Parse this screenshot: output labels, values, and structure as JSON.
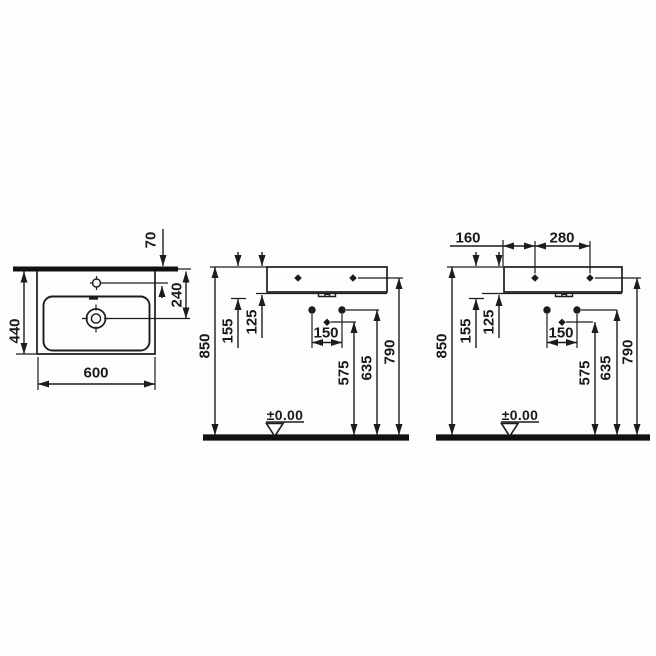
{
  "page": {
    "background": "#fdfdfd",
    "ink_color": "#1c1c1c",
    "description": "Technical dimension drawing of a rectangular wall-hung washbasin, three orthographic views"
  },
  "views": {
    "plan": {
      "dims": {
        "tap_hole_offset": "70",
        "depth": "440",
        "drain_offset": "240",
        "width": "600"
      }
    },
    "elevation_front": {
      "dims": {
        "rim_height": "850",
        "rim_to_boss": "155",
        "apron_depth": "125",
        "fixing_hole_spacing": "150",
        "drain_height": "575",
        "fixing_height": "635",
        "deck_hole_height": "790",
        "floor_datum": "±0.00"
      }
    },
    "elevation_side": {
      "dims": {
        "edge_to_hole": "160",
        "deck_hole_spacing": "280",
        "rim_height": "850",
        "rim_to_boss": "155",
        "apron_depth": "125",
        "fixing_hole_spacing": "150",
        "drain_height": "575",
        "fixing_height": "635",
        "deck_hole_height": "790",
        "floor_datum": "±0.00"
      }
    }
  }
}
